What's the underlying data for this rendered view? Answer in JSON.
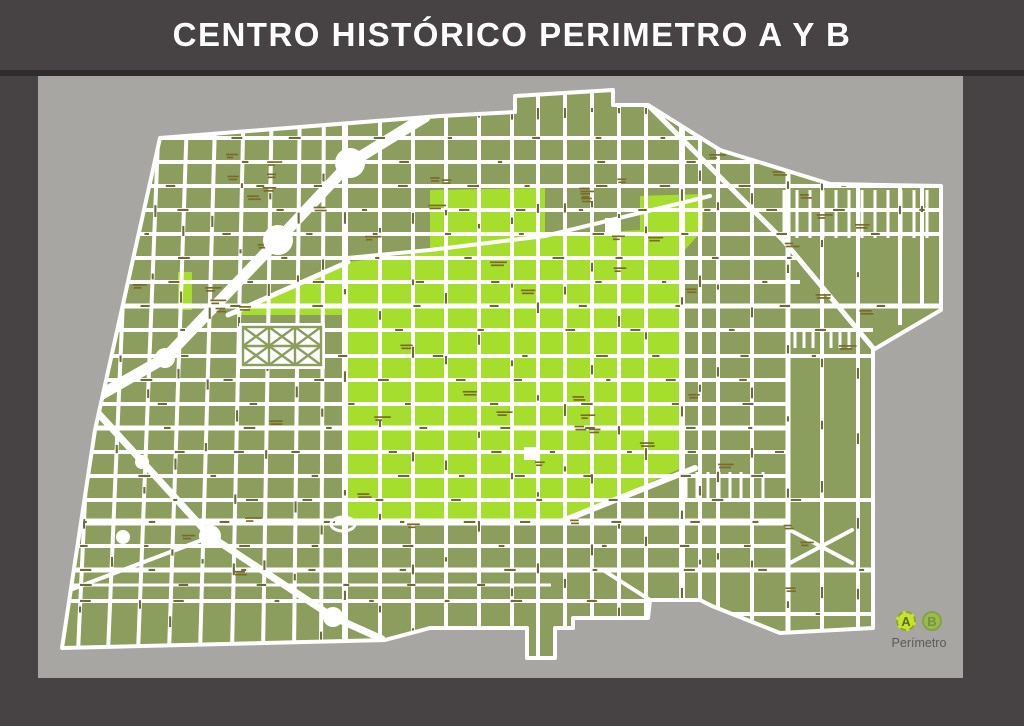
{
  "header": {
    "title": "CENTRO HISTÓRICO PERIMETRO A Y B"
  },
  "legend": {
    "a_label": "A",
    "b_label": "B",
    "caption": "Perímetro"
  },
  "colors": {
    "frame": "#474344",
    "separator": "#2e2c2d",
    "canvas": "#a8a6a3",
    "title": "#ffffff",
    "street": "#ffffff",
    "perimeter_b": "#8c9e5d",
    "perimeter_a": "#a6de2e",
    "street_label": "#6b6b3c",
    "block_label": "#7b6b2a",
    "badge_a_fill": "#c3e52f",
    "badge_a_border": "#95a526",
    "badge_a_text": "#5c6b1d",
    "badge_b_fill": "#9bb94e",
    "badge_b_border": "#84a443",
    "badge_b_text": "#71953b",
    "caption": "#5c595a"
  },
  "map": {
    "outline": [
      [
        160,
        138
      ],
      [
        440,
        116
      ],
      [
        515,
        112
      ],
      [
        515,
        96
      ],
      [
        613,
        90
      ],
      [
        613,
        105
      ],
      [
        648,
        105
      ],
      [
        720,
        150
      ],
      [
        830,
        184
      ],
      [
        941,
        186
      ],
      [
        941,
        310
      ],
      [
        873,
        350
      ],
      [
        873,
        628
      ],
      [
        780,
        633
      ],
      [
        712,
        606
      ],
      [
        700,
        600
      ],
      [
        650,
        600
      ],
      [
        648,
        618
      ],
      [
        573,
        618
      ],
      [
        573,
        628
      ],
      [
        555,
        628
      ],
      [
        555,
        658
      ],
      [
        527,
        658
      ],
      [
        527,
        628
      ],
      [
        430,
        628
      ],
      [
        385,
        640
      ],
      [
        62,
        648
      ],
      [
        95,
        430
      ]
    ],
    "perimeter_a": [
      [
        228,
        315
      ],
      [
        348,
        262
      ],
      [
        430,
        252
      ],
      [
        430,
        190
      ],
      [
        545,
        188
      ],
      [
        545,
        236
      ],
      [
        640,
        230
      ],
      [
        640,
        196
      ],
      [
        703,
        194
      ],
      [
        703,
        230
      ],
      [
        682,
        253
      ],
      [
        682,
        468
      ],
      [
        560,
        522
      ],
      [
        348,
        522
      ],
      [
        348,
        315
      ]
    ],
    "perimeter_a_west": [
      [
        178,
        272
      ],
      [
        192,
        272
      ],
      [
        192,
        310
      ],
      [
        178,
        310
      ]
    ],
    "horizontal_streets": [
      {
        "y": 138,
        "x2": 703
      },
      {
        "y": 162
      },
      {
        "y": 186
      },
      {
        "y": 210
      },
      {
        "y": 234
      },
      {
        "y": 258,
        "x2": 800
      },
      {
        "y": 282,
        "x2": 800
      },
      {
        "y": 306,
        "w": 5
      },
      {
        "y": 330,
        "x2": 873
      },
      {
        "y": 356,
        "x2": 873
      },
      {
        "y": 380,
        "x2": 788
      },
      {
        "y": 404,
        "x2": 788
      },
      {
        "y": 428,
        "x2": 788,
        "w": 5
      },
      {
        "y": 452,
        "x2": 788
      },
      {
        "y": 476,
        "x2": 788
      },
      {
        "y": 500,
        "x2": 873
      },
      {
        "y": 522,
        "x2": 788,
        "w": 7
      },
      {
        "y": 546,
        "x2": 788
      },
      {
        "y": 570,
        "x2": 873,
        "w": 5
      },
      {
        "y": 585,
        "x2": 551,
        "w": 3
      },
      {
        "y": 601,
        "x2": 700
      },
      {
        "y": 614,
        "x1": 700,
        "x2": 873
      }
    ],
    "vertical_streets": [
      {
        "x": 104,
        "dx": -26
      },
      {
        "x": 132,
        "dx": -24
      },
      {
        "x": 160,
        "dx": -22
      },
      {
        "x": 188,
        "dx": -19
      },
      {
        "x": 216,
        "dx": -16
      },
      {
        "x": 244,
        "dx": -12
      },
      {
        "x": 272,
        "dx": -9
      },
      {
        "x": 300,
        "dx": -6
      },
      {
        "x": 324,
        "dx": -3
      },
      {
        "x": 345,
        "w": 6
      },
      {
        "x": 380
      },
      {
        "x": 413
      },
      {
        "x": 446
      },
      {
        "x": 479
      },
      {
        "x": 512
      },
      {
        "x": 538,
        "y2": 660
      },
      {
        "x": 565
      },
      {
        "x": 592
      },
      {
        "x": 619
      },
      {
        "x": 646
      },
      {
        "x": 682,
        "w": 6
      },
      {
        "x": 700
      },
      {
        "x": 718
      },
      {
        "x": 752
      },
      {
        "x": 788,
        "w": 5
      },
      {
        "x": 822
      },
      {
        "x": 858
      },
      {
        "x": 900,
        "y1": 186,
        "y2": 325
      },
      {
        "x": 922,
        "y1": 186,
        "y2": 305
      }
    ],
    "diagonal_streets": [
      {
        "pts": [
          [
            425,
            117
          ],
          [
            350,
            163
          ],
          [
            278,
            240
          ],
          [
            165,
            358
          ],
          [
            88,
            402
          ]
        ],
        "w": 11
      },
      {
        "pts": [
          [
            88,
            402
          ],
          [
            210,
            536
          ],
          [
            333,
            617
          ],
          [
            382,
            639
          ]
        ],
        "w": 7
      },
      {
        "pts": [
          [
            648,
            105
          ],
          [
            783,
            240
          ],
          [
            873,
            348
          ]
        ],
        "w": 5
      },
      {
        "pts": [
          [
            348,
            258
          ],
          [
            430,
            250
          ],
          [
            545,
            236
          ],
          [
            710,
            196
          ]
        ],
        "w": 4
      },
      {
        "pts": [
          [
            560,
            522
          ],
          [
            695,
            468
          ]
        ],
        "w": 6
      },
      {
        "pts": [
          [
            790,
            530
          ],
          [
            852,
            563
          ]
        ],
        "w": 4
      },
      {
        "pts": [
          [
            852,
            530
          ],
          [
            790,
            563
          ]
        ],
        "w": 4
      },
      {
        "pts": [
          [
            603,
            570
          ],
          [
            650,
            600
          ]
        ],
        "w": 4
      },
      {
        "pts": [
          [
            228,
            315
          ],
          [
            348,
            262
          ]
        ],
        "w": 5
      },
      {
        "pts": [
          [
            70,
            590
          ],
          [
            210,
            537
          ]
        ],
        "w": 4
      }
    ],
    "combs": [
      {
        "x1": 784,
        "x2": 938,
        "y": 190,
        "h": 48,
        "step": 13
      },
      {
        "x1": 795,
        "x2": 852,
        "y": 330,
        "h": 18,
        "step": 9
      },
      {
        "x1": 686,
        "x2": 770,
        "y": 472,
        "h": 30,
        "step": 11
      }
    ],
    "roundabouts": [
      {
        "cx": 350,
        "cy": 163,
        "r": 15
      },
      {
        "cx": 278,
        "cy": 240,
        "r": 15
      },
      {
        "cx": 165,
        "cy": 358,
        "r": 10
      },
      {
        "cx": 210,
        "cy": 536,
        "r": 11
      },
      {
        "cx": 333,
        "cy": 617,
        "r": 10
      },
      {
        "cx": 142,
        "cy": 462,
        "r": 7
      },
      {
        "cx": 123,
        "cy": 537,
        "r": 7
      }
    ],
    "ring_ellipse": {
      "cx": 343,
      "cy": 524,
      "rx": 12,
      "ry": 7
    },
    "plazas": [
      {
        "x": 605,
        "y": 218,
        "w": 16,
        "h": 14
      },
      {
        "x": 524,
        "y": 447,
        "w": 12,
        "h": 13
      }
    ],
    "alameda_park": {
      "x": 243,
      "y": 327,
      "w": 78,
      "h": 38
    }
  }
}
